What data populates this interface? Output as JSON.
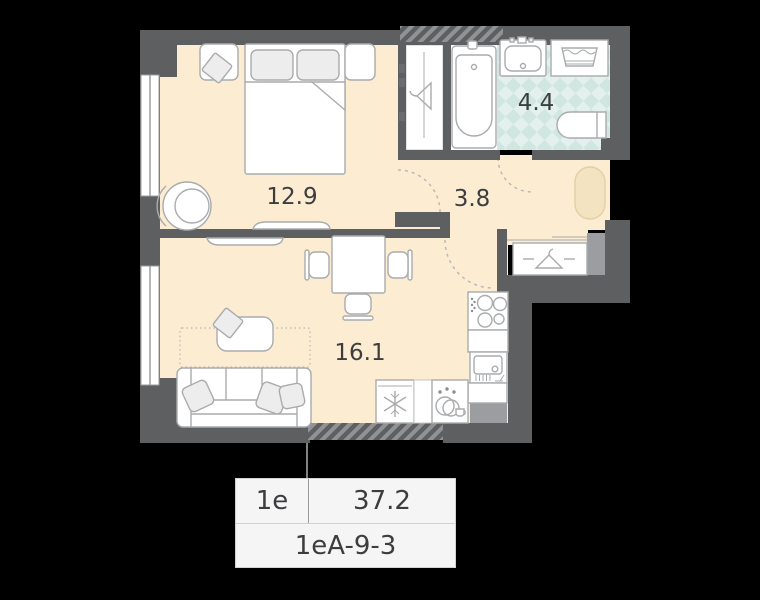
{
  "plan": {
    "rooms": [
      {
        "name": "bedroom",
        "area": "12.9"
      },
      {
        "name": "hallway",
        "area": "3.8"
      },
      {
        "name": "bathroom",
        "area": "4.4"
      },
      {
        "name": "living-kitchen",
        "area": "16.1"
      }
    ],
    "card": {
      "room_type": "1e",
      "total_area": "37.2",
      "layout_code": "1eA-9-3"
    },
    "icons": {
      "bedroom_wardrobe": "hanger-icon",
      "entry_wardrobe": "hanger-icon",
      "fridge": "snowflake-icon",
      "dishwasher": "dishes-icon",
      "bathtub": "bathtub-icon",
      "washing_machine": "washing-machine-icon",
      "toilet": "toilet-icon",
      "bathroom_sink": "sink-icon",
      "kitchen_sink": "sink-icon",
      "cooktop": "burners-icon",
      "entry_rug": "rug-oval"
    }
  },
  "colors": {
    "background": "#000000",
    "wall-dark": "#5e5f61",
    "wall-light": "#9c9da0",
    "floor": "#fcecd2",
    "rug": "#f4e3c0",
    "rug-border": "#e2cfa3",
    "tile-base": "#e4f0ed",
    "tile-diamond": "#cfe6e1",
    "furniture-stroke": "#a9abad",
    "fixture-fill": "#ededee",
    "hatch-base": "#919295",
    "ink": "#3c3d3f",
    "card-bg": "#f5f5f6",
    "card-border": "#d2d2d4",
    "card-divider": "#98999b",
    "connector": "#808183"
  }
}
